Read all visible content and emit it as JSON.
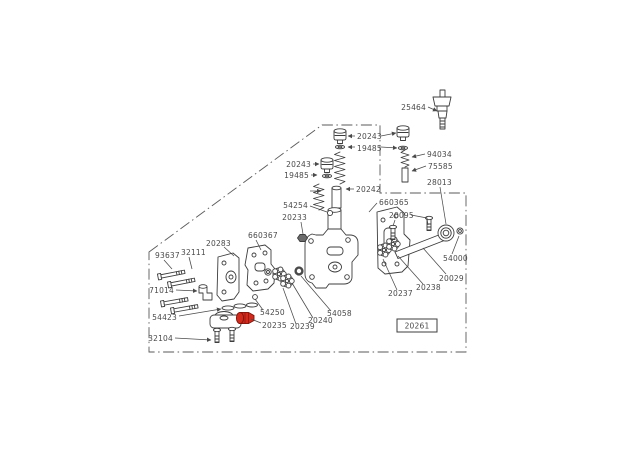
{
  "page": {
    "background": "#ffffff"
  },
  "diagram": {
    "type": "exploded-parts-diagram",
    "line_color": "#3d3d3d",
    "label_color": "#4a4a4a",
    "highlight_color": "#d22b1d",
    "boxed_reference": "20261",
    "labels": [
      {
        "text": "25464"
      },
      {
        "text": "20243"
      },
      {
        "text": "19485"
      },
      {
        "text": "20243"
      },
      {
        "text": "19485"
      },
      {
        "text": "94034"
      },
      {
        "text": "75585"
      },
      {
        "text": "28013"
      },
      {
        "text": "20242"
      },
      {
        "text": "54254"
      },
      {
        "text": "20233"
      },
      {
        "text": "660365"
      },
      {
        "text": "20095"
      },
      {
        "text": "660367"
      },
      {
        "text": "20283"
      },
      {
        "text": "93637"
      },
      {
        "text": "32111"
      },
      {
        "text": "71014"
      },
      {
        "text": "54423"
      },
      {
        "text": "32104"
      },
      {
        "text": "20235"
      },
      {
        "text": "54250"
      },
      {
        "text": "20239"
      },
      {
        "text": "20240"
      },
      {
        "text": "54058"
      },
      {
        "text": "20237"
      },
      {
        "text": "20238"
      },
      {
        "text": "20029"
      },
      {
        "text": "54000"
      }
    ]
  }
}
